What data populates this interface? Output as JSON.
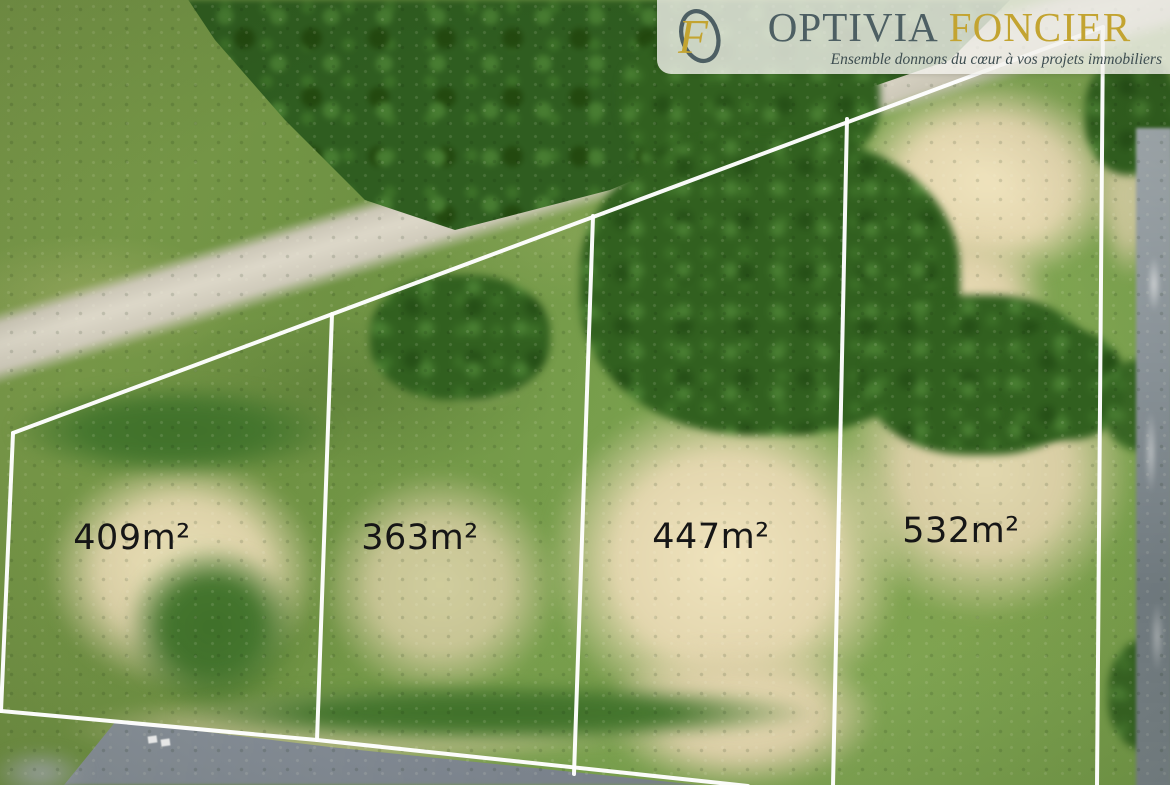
{
  "logo": {
    "brand_primary": "OPTIVIA",
    "brand_secondary": "FONCIER",
    "tagline": "Ensemble donnons du cœur à vos projets immobiliers",
    "monogram_f": "F",
    "colors": {
      "primary": "#4d5f63",
      "gold": "#c3a431",
      "panel": "#f3f1ec"
    }
  },
  "plots": [
    {
      "area_label": "409m²"
    },
    {
      "area_label": "363m²"
    },
    {
      "area_label": "447m²"
    },
    {
      "area_label": "532m²"
    }
  ],
  "overlay": {
    "boundary_color": "#ffffff",
    "label_color": "#161616"
  }
}
